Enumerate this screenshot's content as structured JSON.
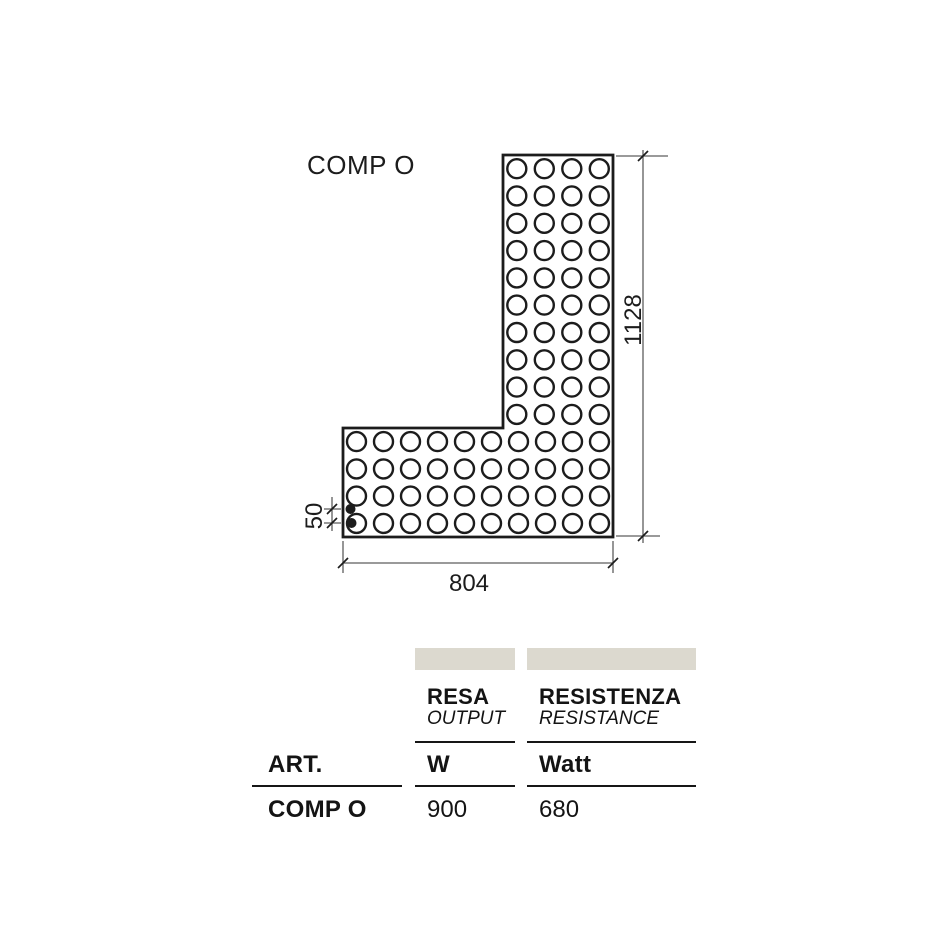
{
  "page": {
    "title": "COMP O"
  },
  "colors": {
    "ink": "#1c1c1c",
    "dim_line": "#5d5d5d",
    "bar_fill": "#dcd9cf",
    "background": "#ffffff"
  },
  "diagram": {
    "outline": [
      [
        503,
        155
      ],
      [
        613,
        155
      ],
      [
        613,
        537
      ],
      [
        343,
        537
      ],
      [
        343,
        428
      ],
      [
        503,
        428
      ]
    ],
    "circle_radius": 9.5,
    "grids": [
      {
        "name": "vertical-arm",
        "x0": 503,
        "y0": 155,
        "cols": 4,
        "rows": 10,
        "pitch_x": 27.5,
        "pitch_y": 27.3
      },
      {
        "name": "bottom-arm",
        "x0": 343,
        "y0": 428,
        "cols": 10,
        "rows": 4,
        "pitch_x": 27.0,
        "pitch_y": 27.25
      }
    ],
    "connection_dots": {
      "radius": 5,
      "points": [
        [
          350.5,
          509
        ],
        [
          351.5,
          523
        ]
      ]
    },
    "dimensions": [
      {
        "name": "overall-height",
        "label": "1128",
        "rotate": true,
        "line": [
          643,
          150,
          643,
          543
        ],
        "extensions": [
          [
            616,
            156,
            668,
            156
          ],
          [
            616,
            536,
            660,
            536
          ]
        ],
        "slashes": [
          [
            643,
            156
          ],
          [
            643,
            536
          ]
        ],
        "label_pos": [
          641,
          320
        ]
      },
      {
        "name": "overall-width",
        "label": "804",
        "rotate": false,
        "line": [
          343,
          563,
          613,
          563
        ],
        "extensions": [
          [
            343,
            541,
            343,
            573
          ],
          [
            613,
            541,
            613,
            573
          ]
        ],
        "slashes": [
          [
            343,
            563
          ],
          [
            613,
            563
          ]
        ],
        "label_pos": [
          469,
          591
        ]
      },
      {
        "name": "connection-pitch",
        "label": "50",
        "rotate": true,
        "line": [
          332,
          497,
          332,
          531
        ],
        "extensions": [
          [
            324,
            509,
            341,
            509
          ],
          [
            324,
            523,
            341,
            523
          ]
        ],
        "slashes": [
          [
            332,
            509
          ],
          [
            332,
            523
          ]
        ],
        "label_pos": [
          322,
          516
        ]
      }
    ]
  },
  "table": {
    "art_label": "ART.",
    "row_label": "COMP O",
    "columns": [
      {
        "title": "RESA",
        "subtitle": "OUTPUT",
        "unit": "W",
        "value": "900"
      },
      {
        "title": "RESISTENZA",
        "subtitle": "RESISTANCE",
        "unit": "Watt",
        "value": "680"
      }
    ]
  }
}
